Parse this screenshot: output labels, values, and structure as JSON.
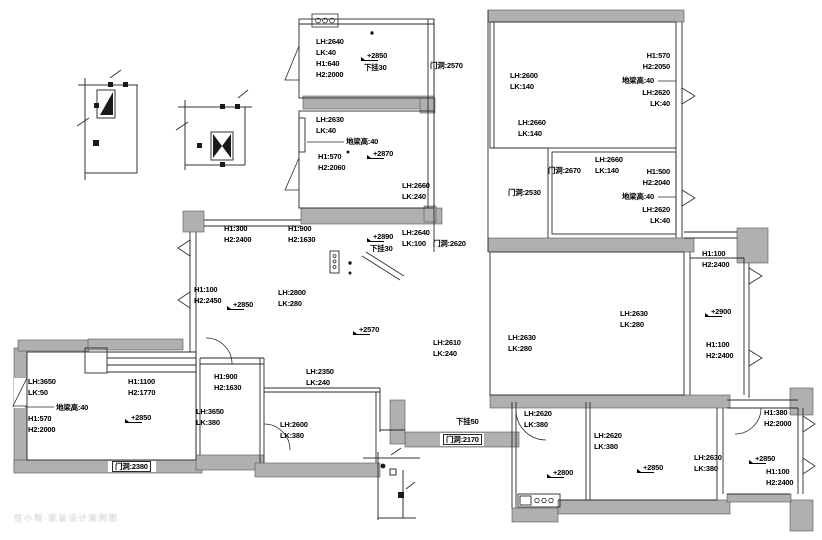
{
  "meta": {
    "drawing_type": "floor-plan-measurement-drawing"
  },
  "colors": {
    "background": "#ffffff",
    "wall_fill": "#b0b0b0",
    "wall_edge": "#555555",
    "line": "#2a2a2a",
    "text": "#000000"
  },
  "watermark": {
    "text": "住小帮·家装设计案例图",
    "x": 14,
    "y": 512
  },
  "annotations": [
    {
      "name": "r1-measure",
      "x": 316,
      "y": 36,
      "lines": [
        "LH:2640",
        "LK:40",
        "H1:640",
        "H2:2000"
      ]
    },
    {
      "name": "r1-elevation",
      "x": 364,
      "y": 50,
      "type": "e",
      "lines": [
        "+2850",
        "下挂30"
      ]
    },
    {
      "name": "door-top-corridor",
      "x": 430,
      "y": 60,
      "lines": [
        "门洞:2570"
      ]
    },
    {
      "name": "r3-measure-left",
      "x": 510,
      "y": 70,
      "lines": [
        "LH:2600",
        "LK:140"
      ]
    },
    {
      "name": "r3-window-right",
      "x": 670,
      "y": 50,
      "align": "r",
      "lines": [
        "H1:570",
        "H2:2050"
      ]
    },
    {
      "name": "r3-floorbeam-right",
      "x": 654,
      "y": 75,
      "align": "r",
      "lines": [
        "地梁高:40"
      ]
    },
    {
      "name": "r3-measure-right",
      "x": 670,
      "y": 87,
      "align": "r",
      "lines": [
        "LH:2620",
        "LK:40"
      ]
    },
    {
      "name": "r3-measure-bottom",
      "x": 518,
      "y": 117,
      "lines": [
        "LH:2660",
        "LK:140"
      ]
    },
    {
      "name": "door-hall2",
      "x": 508,
      "y": 187,
      "lines": [
        "门洞:2530"
      ]
    },
    {
      "name": "door-r4",
      "x": 548,
      "y": 165,
      "lines": [
        "门洞:2670"
      ]
    },
    {
      "name": "r4-measure",
      "x": 595,
      "y": 154,
      "lines": [
        "LH:2660",
        "LK:140"
      ]
    },
    {
      "name": "r4-window-right",
      "x": 670,
      "y": 166,
      "align": "r",
      "lines": [
        "H1:500",
        "H2:2040"
      ]
    },
    {
      "name": "r4-floorbeam-right",
      "x": 654,
      "y": 191,
      "align": "r",
      "lines": [
        "地梁高:40"
      ]
    },
    {
      "name": "r4-measure-right",
      "x": 670,
      "y": 204,
      "align": "r",
      "lines": [
        "LH:2620",
        "LK:40"
      ]
    },
    {
      "name": "r2-measure-left",
      "x": 316,
      "y": 114,
      "lines": [
        "LH:2630",
        "LK:40"
      ]
    },
    {
      "name": "r2-floorbeam",
      "x": 346,
      "y": 136,
      "lines": [
        "地梁高:40"
      ]
    },
    {
      "name": "r2-window-left",
      "x": 318,
      "y": 151,
      "lines": [
        "H1:570",
        "H2:2060"
      ]
    },
    {
      "name": "r2-elevation",
      "x": 370,
      "y": 148,
      "type": "e",
      "lines": [
        "+2870"
      ]
    },
    {
      "name": "r2-measure-br",
      "x": 402,
      "y": 180,
      "lines": [
        "LH:2660",
        "LK:240"
      ]
    },
    {
      "name": "vest-elevation",
      "x": 370,
      "y": 231,
      "type": "e",
      "lines": [
        "+2890",
        "下挂30"
      ]
    },
    {
      "name": "vest-measure",
      "x": 402,
      "y": 227,
      "lines": [
        "LH:2640",
        "LK:100"
      ]
    },
    {
      "name": "door-vest",
      "x": 433,
      "y": 238,
      "lines": [
        "门洞:2620"
      ]
    },
    {
      "name": "hall-window-top",
      "x": 224,
      "y": 223,
      "lines": [
        "H1:300",
        "H2:2400"
      ]
    },
    {
      "name": "hall-window-top2",
      "x": 288,
      "y": 223,
      "lines": [
        "H1:900",
        "H2:1630"
      ]
    },
    {
      "name": "hall-window-left",
      "x": 194,
      "y": 284,
      "lines": [
        "H1:100",
        "H2:2450"
      ]
    },
    {
      "name": "hall-elevation-1",
      "x": 230,
      "y": 299,
      "type": "e",
      "lines": [
        "+2850"
      ]
    },
    {
      "name": "hall-measure",
      "x": 278,
      "y": 287,
      "lines": [
        "LH:2800",
        "LK:280"
      ]
    },
    {
      "name": "hall-elevation-2",
      "x": 356,
      "y": 324,
      "type": "e",
      "lines": [
        "+2570"
      ]
    },
    {
      "name": "hall-measure-br",
      "x": 433,
      "y": 337,
      "lines": [
        "LH:2610",
        "LK:240"
      ]
    },
    {
      "name": "r5-measure-left",
      "x": 508,
      "y": 332,
      "lines": [
        "LH:2630",
        "LK:280"
      ]
    },
    {
      "name": "r5-measure-right",
      "x": 620,
      "y": 308,
      "lines": [
        "LH:2630",
        "LK:280"
      ]
    },
    {
      "name": "r6-window-1",
      "x": 702,
      "y": 248,
      "lines": [
        "H1:100",
        "H2:2400"
      ]
    },
    {
      "name": "r6-elevation",
      "x": 708,
      "y": 306,
      "type": "e",
      "lines": [
        "+2900"
      ]
    },
    {
      "name": "r6-window-2",
      "x": 706,
      "y": 339,
      "lines": [
        "H1:100",
        "H2:2400"
      ]
    },
    {
      "name": "r8-measure",
      "x": 28,
      "y": 376,
      "lines": [
        "LH:3650",
        "LK:50"
      ]
    },
    {
      "name": "r8-window-top",
      "x": 128,
      "y": 376,
      "lines": [
        "H1:1100",
        "H2:1770"
      ]
    },
    {
      "name": "r8-floorbeam",
      "x": 56,
      "y": 402,
      "lines": [
        "地梁高:40"
      ]
    },
    {
      "name": "r8-window-left",
      "x": 28,
      "y": 413,
      "lines": [
        "H1:570",
        "H2:2000"
      ]
    },
    {
      "name": "r8-elevation",
      "x": 128,
      "y": 412,
      "type": "e",
      "lines": [
        "+2850"
      ]
    },
    {
      "name": "door-r8",
      "x": 112,
      "y": 461,
      "boxed": true,
      "lines": [
        "门洞:2380"
      ]
    },
    {
      "name": "r9-window",
      "x": 214,
      "y": 371,
      "lines": [
        "H1:900",
        "H2:1630"
      ]
    },
    {
      "name": "r9-measure",
      "x": 196,
      "y": 406,
      "lines": [
        "LH:3650",
        "LK:380"
      ]
    },
    {
      "name": "hall-measure-bottom",
      "x": 306,
      "y": 366,
      "lines": [
        "LH:2350",
        "LK:240"
      ]
    },
    {
      "name": "r10-measure",
      "x": 280,
      "y": 419,
      "lines": [
        "LH:2600",
        "LK:380"
      ]
    },
    {
      "name": "hall-drop",
      "x": 456,
      "y": 416,
      "lines": [
        "下挂50"
      ]
    },
    {
      "name": "door-hall-bottom",
      "x": 443,
      "y": 434,
      "boxed": true,
      "lines": [
        "门洞:2170"
      ]
    },
    {
      "name": "kitchen-measure",
      "x": 524,
      "y": 408,
      "lines": [
        "LH:2620",
        "LK:380"
      ]
    },
    {
      "name": "kitchen-elevation",
      "x": 550,
      "y": 467,
      "type": "e",
      "lines": [
        "+2800"
      ]
    },
    {
      "name": "mid-measure",
      "x": 594,
      "y": 430,
      "lines": [
        "LH:2620",
        "LK:380"
      ]
    },
    {
      "name": "mid-elevation",
      "x": 640,
      "y": 462,
      "type": "e",
      "lines": [
        "+2850"
      ]
    },
    {
      "name": "mid-measure-right",
      "x": 694,
      "y": 452,
      "lines": [
        "LH:2630",
        "LK:380"
      ]
    },
    {
      "name": "br-window-top",
      "x": 764,
      "y": 407,
      "lines": [
        "H1:380",
        "H2:2000"
      ]
    },
    {
      "name": "br-elevation",
      "x": 752,
      "y": 453,
      "type": "e",
      "lines": [
        "+2850"
      ]
    },
    {
      "name": "br-window-right",
      "x": 766,
      "y": 466,
      "lines": [
        "H1:100",
        "H2:2400"
      ]
    }
  ]
}
